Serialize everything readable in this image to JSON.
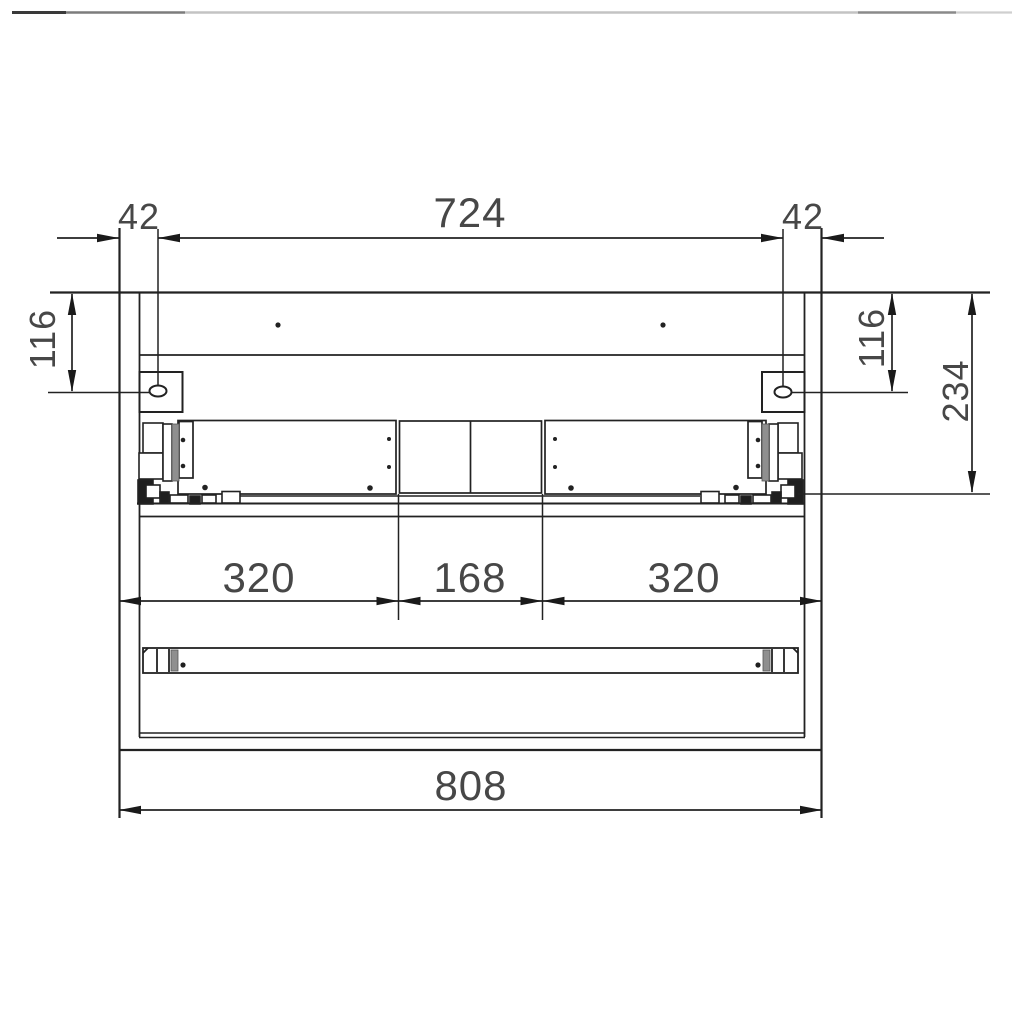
{
  "drawing": {
    "kind": "cabinet front elevation, dimensioned technical drawing",
    "units_implied": "mm",
    "labels": {
      "offset_left": "42",
      "span_top": "724",
      "offset_right": "42",
      "height_left": "116",
      "height_right": "116",
      "height_total_right": "234",
      "width_left_drawer": "320",
      "width_center": "168",
      "width_right_drawer": "320",
      "width_overall": "808"
    },
    "colors": {
      "background": "#ffffff",
      "line": "#222222",
      "dimension_text": "#474747",
      "slide_strip_gray": "#8f8f8f",
      "top_border_dark": "#3a3a3a",
      "top_border_light": "#c3c3c3"
    }
  }
}
